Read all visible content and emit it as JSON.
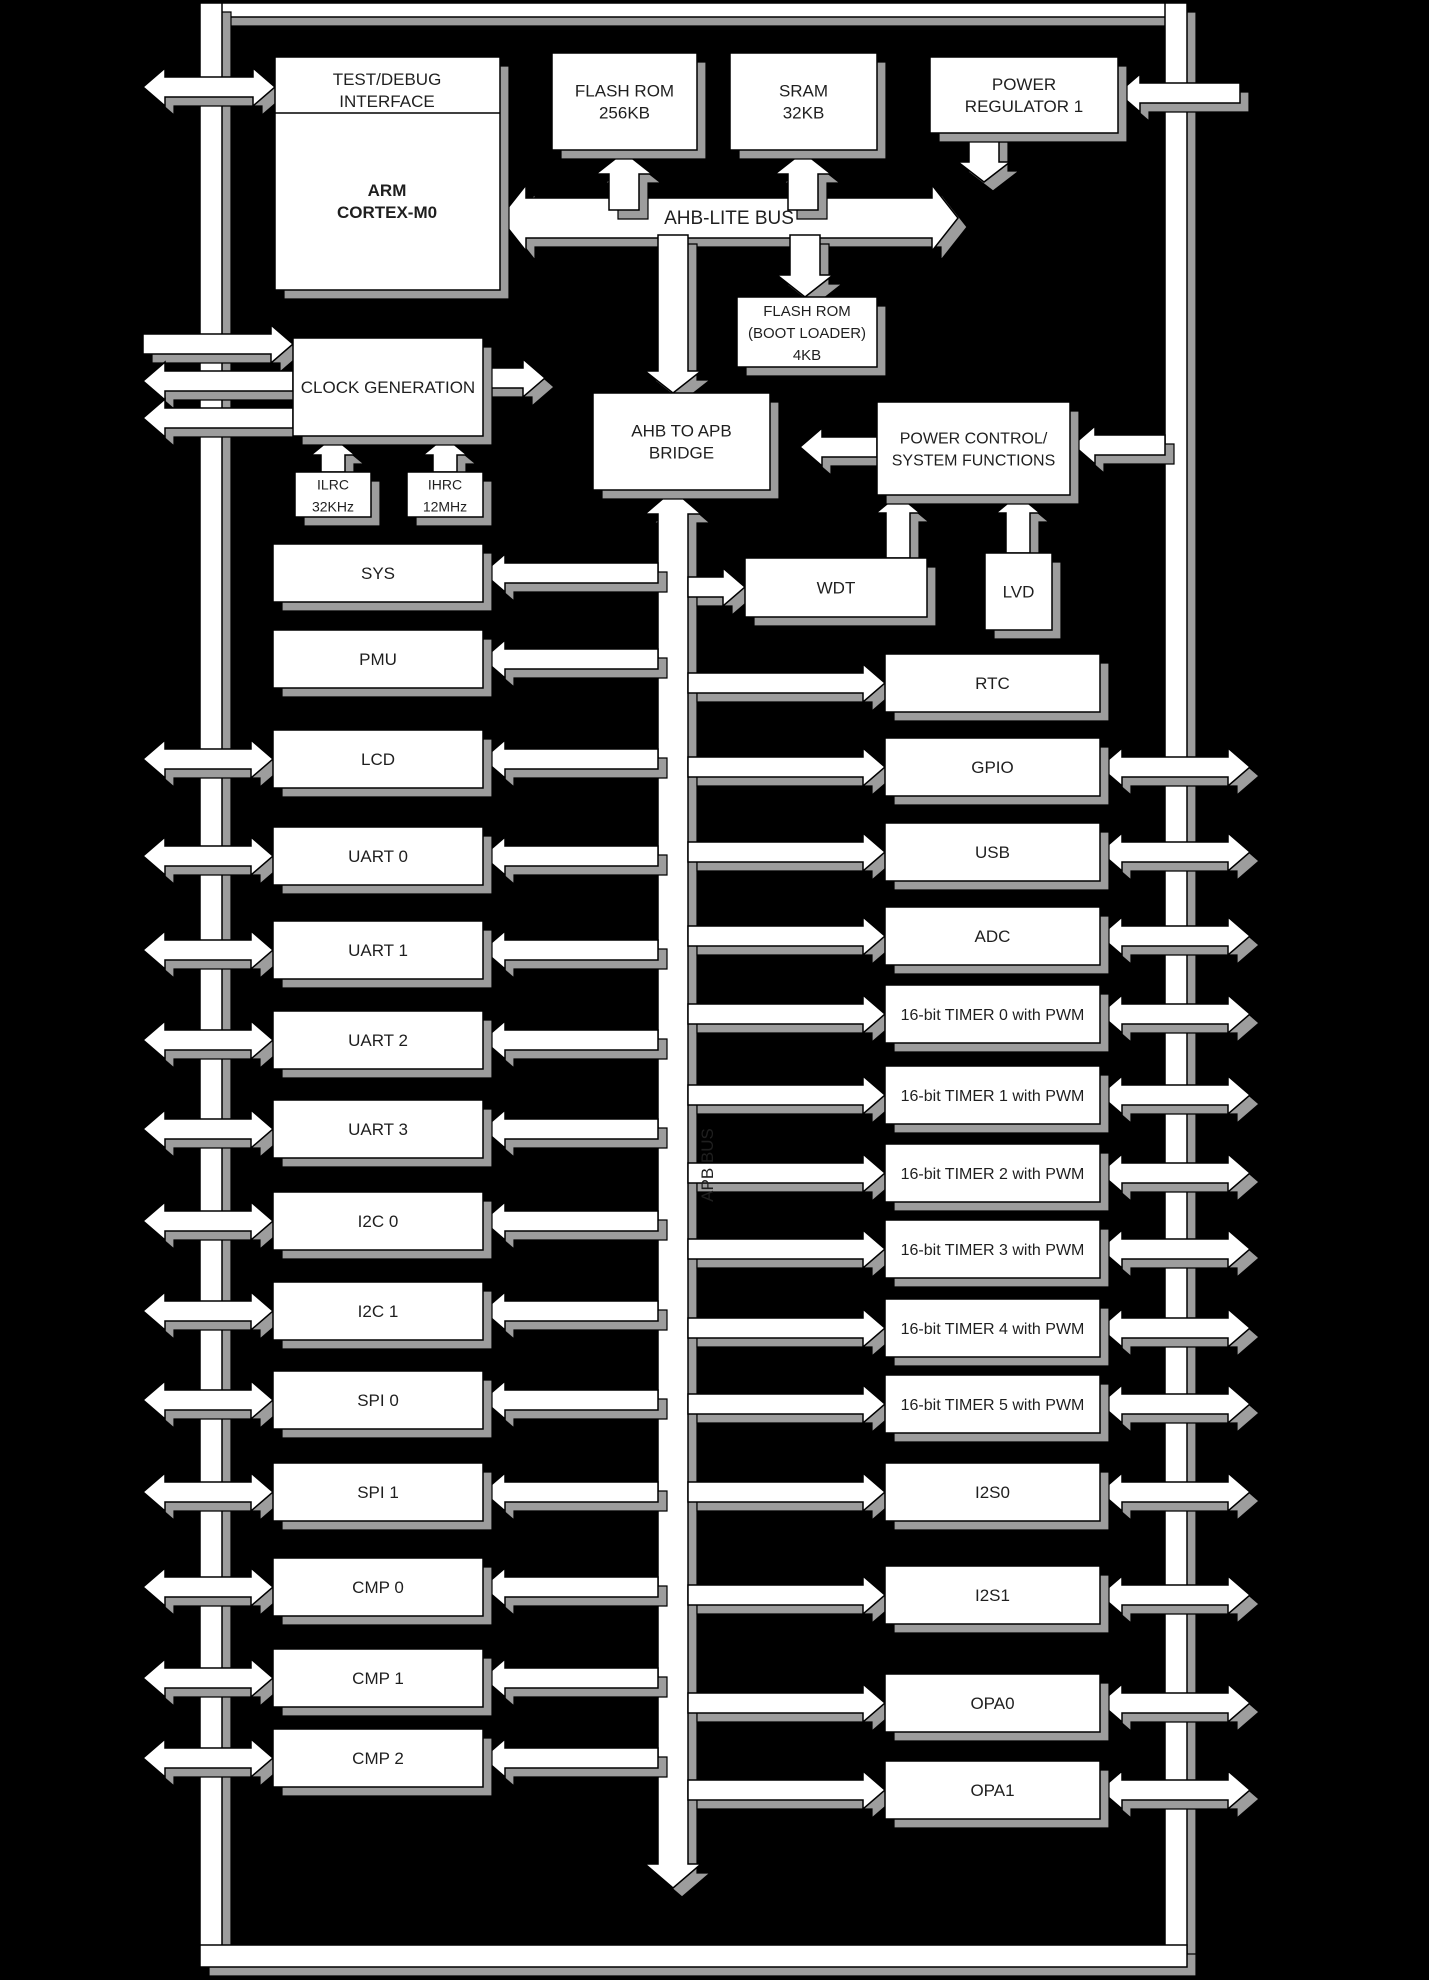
{
  "title": "ARM Cortex-M0 MCU Block Diagram",
  "colors": {
    "background": "#000000",
    "fill": "#ffffff",
    "line": "#000000",
    "shadow": "#9d9d9d",
    "text": "#1f1f1f"
  },
  "blocks": {
    "test_debug": [
      "TEST/DEBUG",
      "INTERFACE"
    ],
    "arm": [
      "ARM",
      "CORTEX-M0"
    ],
    "flash_rom": [
      "FLASH ROM",
      "256KB"
    ],
    "sram": [
      "SRAM",
      "32KB"
    ],
    "power_regulator": [
      "POWER",
      "REGULATOR 1"
    ],
    "boot_rom": [
      "FLASH ROM",
      "(BOOT LOADER)",
      "4KB"
    ],
    "clock_generation": "CLOCK GENERATION",
    "ilrc": [
      "ILRC",
      "32KHz"
    ],
    "ihrc": [
      "IHRC",
      "12MHz"
    ],
    "bridge": [
      "AHB TO APB",
      "BRIDGE"
    ],
    "power_control": [
      "POWER CONTROL/",
      "SYSTEM FUNCTIONS"
    ],
    "wdt": "WDT",
    "lvd": "LVD"
  },
  "buses": {
    "ahb": "AHB-LITE BUS",
    "apb": "APB BUS"
  },
  "left_peripherals": [
    {
      "label": "SYS",
      "external": false
    },
    {
      "label": "PMU",
      "external": false
    },
    {
      "label": "LCD",
      "external": true
    },
    {
      "label": "UART 0",
      "external": true
    },
    {
      "label": "UART 1",
      "external": true
    },
    {
      "label": "UART 2",
      "external": true
    },
    {
      "label": "UART 3",
      "external": true
    },
    {
      "label": "I2C 0",
      "external": true
    },
    {
      "label": "I2C 1",
      "external": true
    },
    {
      "label": "SPI 0",
      "external": true
    },
    {
      "label": "SPI 1",
      "external": true
    },
    {
      "label": "CMP 0",
      "external": true
    },
    {
      "label": "CMP 1",
      "external": true
    },
    {
      "label": "CMP 2",
      "external": true
    }
  ],
  "right_peripherals": [
    {
      "label": "RTC",
      "external": false
    },
    {
      "label": "GPIO",
      "external": true
    },
    {
      "label": "USB",
      "external": true
    },
    {
      "label": "ADC",
      "external": true
    },
    {
      "label": "16-bit TIMER 0 with PWM",
      "external": true
    },
    {
      "label": "16-bit TIMER 1 with PWM",
      "external": true
    },
    {
      "label": "16-bit TIMER 2 with PWM",
      "external": true
    },
    {
      "label": "16-bit TIMER 3 with PWM",
      "external": true
    },
    {
      "label": "16-bit TIMER 4 with PWM",
      "external": true
    },
    {
      "label": "16-bit TIMER 5 with PWM",
      "external": true
    },
    {
      "label": "I2S0",
      "external": true
    },
    {
      "label": "I2S1",
      "external": true
    },
    {
      "label": "OPA0",
      "external": true
    },
    {
      "label": "OPA1",
      "external": true
    }
  ]
}
